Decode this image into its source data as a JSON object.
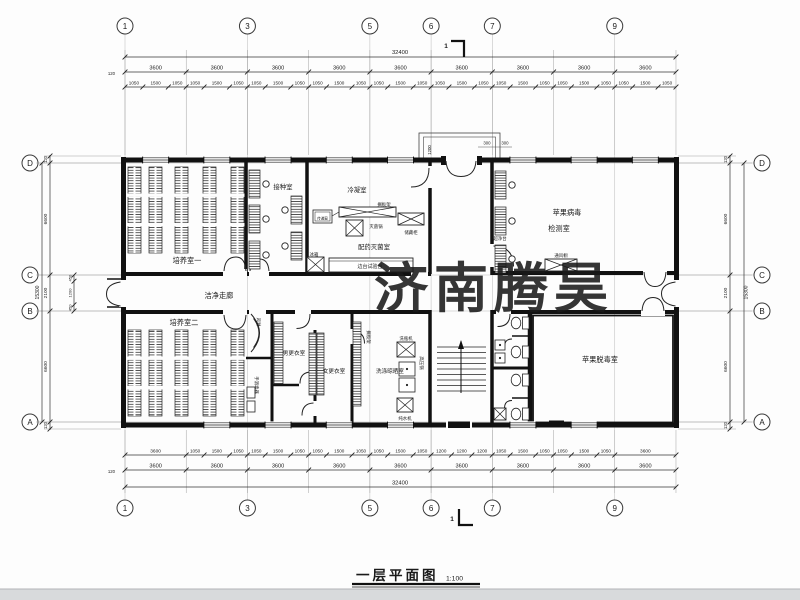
{
  "watermark": {
    "text": "济南腾昊",
    "color": "#E0343B"
  },
  "title": {
    "text": "一层平面图",
    "scale": "1:100"
  },
  "section_mark": "1",
  "grid": {
    "column_labels": [
      "1",
      "3",
      "5",
      "6",
      "7",
      "9"
    ],
    "row_labels": [
      "D",
      "C",
      "B",
      "A"
    ]
  },
  "dims": {
    "top": {
      "overall": "32400",
      "offset": "120",
      "bay": "3600",
      "subs": [
        "1050",
        "1500",
        "1050"
      ]
    },
    "bottom": {
      "overall": "32400",
      "offset": "120",
      "bay": "3600",
      "per_bay": [
        [
          "3600"
        ],
        [
          "1050",
          "1500",
          "1050"
        ],
        [
          "1050",
          "1500",
          "1050"
        ],
        [
          "1050",
          "1500",
          "1050"
        ],
        [
          "1050",
          "1500",
          "1050"
        ],
        [
          "1200",
          "1200",
          "1200"
        ],
        [
          "1050",
          "1500",
          "1050"
        ],
        [
          "1050",
          "1500",
          "1050"
        ],
        [
          "3600"
        ]
      ]
    },
    "side": {
      "overall": "15300",
      "values": [
        "120",
        "6600",
        "2100",
        "6600",
        "120"
      ],
      "subs": [
        "450",
        "1200",
        "450"
      ]
    },
    "porch": {
      "depth": "1200",
      "cols": [
        "300",
        "300"
      ]
    }
  },
  "rooms": {
    "cultivation1": "培养室一",
    "inoculation": "接种室",
    "condensation": "冷凝室",
    "preparation": "配药灭菌室",
    "detection1": "苹果病毒",
    "detection2": "检测室",
    "corridor": "洁净走廊",
    "cultivation2": "培养室二",
    "men_changing": "男更衣室",
    "women_changing": "女更衣室",
    "washing": "洗涤晾晒室",
    "detox": "苹果脱毒室",
    "air_shower": "风淋"
  },
  "equipment": {
    "sterilizer": "灭菌锅",
    "storage_cabinet": "储藏柜",
    "shelf_rack": "搁板架",
    "pass_window": "传递窗",
    "fridge": "冰箱",
    "side_bench": "边台试验台",
    "clean_bench": "超净台",
    "fume_hood": "通风橱",
    "bottle_washer": "洗瓶机",
    "autoclave": "高压锅",
    "water_purifier": "纯水机",
    "hand_sanitizer": "手消毒器",
    "shelf_rack2": "搁板架"
  },
  "colors": {
    "line": "#1a1a1a",
    "paper": "#fdfdfd",
    "footer_bar": "#d8dadc"
  }
}
